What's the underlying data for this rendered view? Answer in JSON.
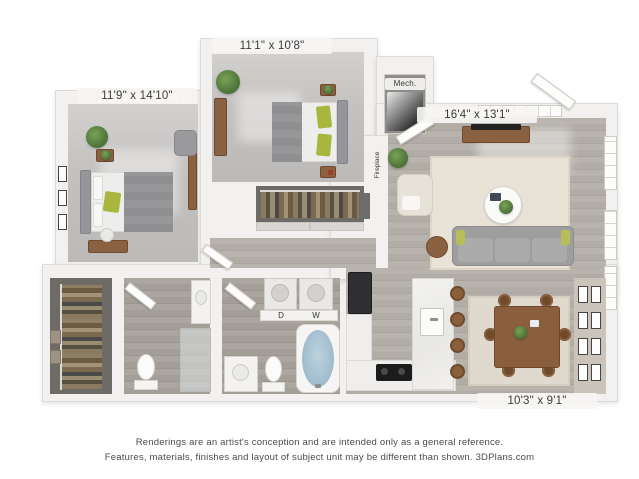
{
  "title": "3D apartment floor plan rendering",
  "labels": {
    "bedroom1": "11'9\" x 14'10\"",
    "bedroom2": "11'1\" x 10'8\"",
    "living": "16'4\" x 13'1\"",
    "dining": "10'3\" x 9'1\"",
    "mech": "Mech.",
    "fireplace": "Fireplace",
    "dryer": "D",
    "washer": "W"
  },
  "footer": {
    "line1": "Renderings are an artist's conception and are intended only as a general reference.",
    "line2": "Features, materials, finishes and layout of subject unit may be different than shown. 3DPlans.com"
  },
  "colors": {
    "background": "#ffffff",
    "wall": "#f2f1ef",
    "carpet": "#c3c1bf",
    "wood_floor": "#b1aca6",
    "closet_floor": "#6e6a66",
    "living_rug": "#e9e2d6",
    "dining_rug": "#dfd9ce",
    "sofa": "#9e9e9e",
    "wood_furniture": "#8a6242",
    "accent_green_pillow": "#a9b63e",
    "plant_green": "#4e7539",
    "tub_water": "#aac4d3",
    "tv_black": "#222222",
    "label_text": "#3b3b3b",
    "footer_text": "#4a4a4a"
  }
}
